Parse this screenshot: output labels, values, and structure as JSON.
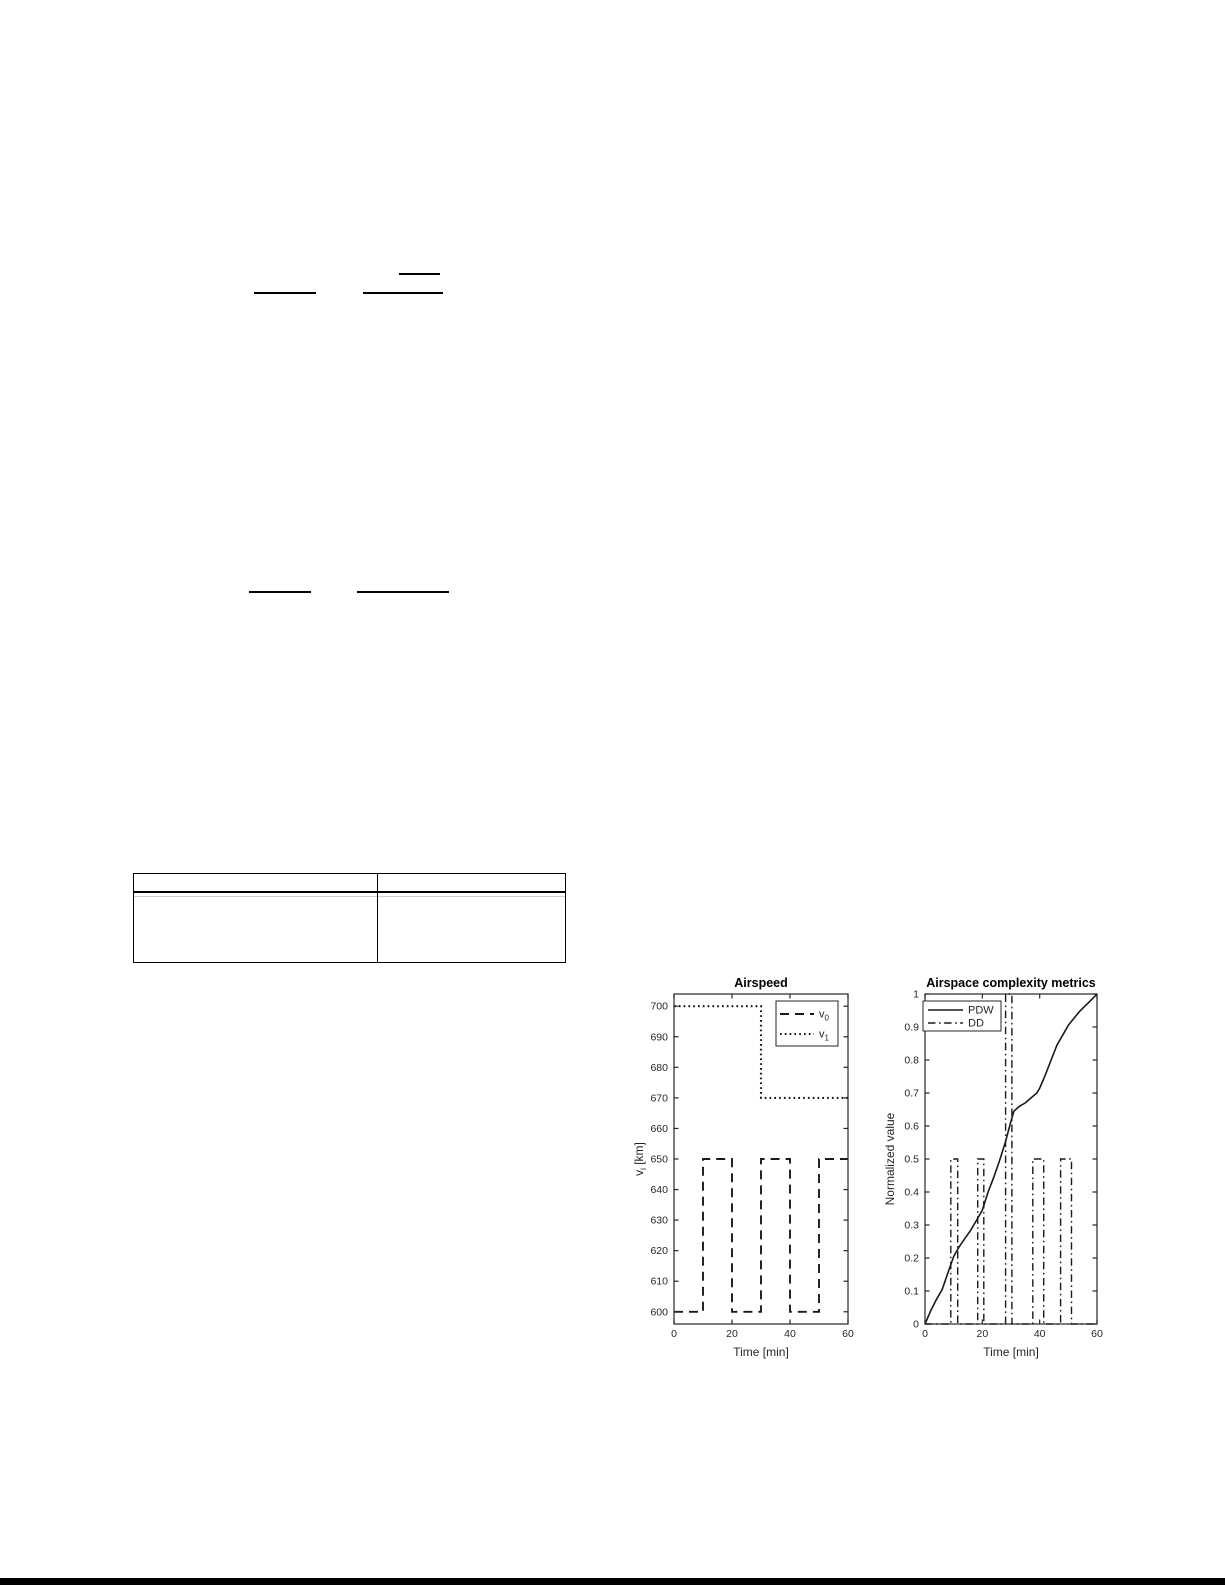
{
  "page": {
    "background": "#ffffff",
    "bottom_rule_color": "#000000"
  },
  "table": {
    "header_cells": [
      "",
      ""
    ],
    "body_cells": [
      "",
      ""
    ]
  },
  "colors": {
    "series": "#1a1a1a",
    "axis": "#262626",
    "title": "#000000",
    "legend_bg": "#ffffff"
  },
  "chart_data": [
    {
      "type": "line",
      "title": "Airspeed",
      "xlabel": "Time [min]",
      "ylabel": {
        "base": "v",
        "sub": "i",
        "rest": " [km]"
      },
      "xlim": [
        0,
        60
      ],
      "ylim": [
        596,
        704
      ],
      "xticks": [
        0,
        20,
        40,
        60
      ],
      "yticks": [
        600,
        610,
        620,
        630,
        640,
        650,
        660,
        670,
        680,
        690,
        700
      ],
      "grid": false,
      "legend_position": "top-right",
      "series": [
        {
          "name": {
            "base": "v",
            "sub": "0"
          },
          "style": "dashed",
          "points": [
            [
              0,
              600
            ],
            [
              10,
              600
            ],
            [
              10,
              650
            ],
            [
              20,
              650
            ],
            [
              20,
              600
            ],
            [
              30,
              600
            ],
            [
              30,
              650
            ],
            [
              40,
              650
            ],
            [
              40,
              600
            ],
            [
              50,
              600
            ],
            [
              50,
              650
            ],
            [
              60,
              650
            ]
          ]
        },
        {
          "name": {
            "base": "v",
            "sub": "1"
          },
          "style": "dotted",
          "points": [
            [
              0,
              700
            ],
            [
              30,
              700
            ],
            [
              30,
              670
            ],
            [
              60,
              670
            ]
          ]
        }
      ]
    },
    {
      "type": "line",
      "title": "Airspace complexity metrics",
      "xlabel": "Time [min]",
      "ylabel": {
        "base": "Normalized value",
        "sub": "",
        "rest": ""
      },
      "xlim": [
        0,
        60
      ],
      "ylim": [
        0,
        1
      ],
      "xticks": [
        0,
        20,
        40,
        60
      ],
      "yticks": [
        0,
        0.1,
        0.2,
        0.3,
        0.4,
        0.5,
        0.6,
        0.7,
        0.8,
        0.9,
        1
      ],
      "grid": false,
      "legend_position": "top-left",
      "series": [
        {
          "name": {
            "base": "PDW",
            "sub": ""
          },
          "style": "solid",
          "points": [
            [
              0,
              0
            ],
            [
              2,
              0.04
            ],
            [
              4,
              0.075
            ],
            [
              6,
              0.105
            ],
            [
              8,
              0.155
            ],
            [
              10,
              0.205
            ],
            [
              12,
              0.235
            ],
            [
              14,
              0.26
            ],
            [
              16,
              0.285
            ],
            [
              18,
              0.315
            ],
            [
              20,
              0.345
            ],
            [
              22,
              0.4
            ],
            [
              24,
              0.445
            ],
            [
              26,
              0.495
            ],
            [
              28,
              0.55
            ],
            [
              30,
              0.615
            ],
            [
              31,
              0.645
            ],
            [
              33,
              0.66
            ],
            [
              35,
              0.67
            ],
            [
              37,
              0.685
            ],
            [
              39,
              0.7
            ],
            [
              40,
              0.715
            ],
            [
              42,
              0.755
            ],
            [
              44,
              0.8
            ],
            [
              46,
              0.845
            ],
            [
              48,
              0.875
            ],
            [
              50,
              0.905
            ],
            [
              52,
              0.927
            ],
            [
              54,
              0.948
            ],
            [
              56,
              0.965
            ],
            [
              58,
              0.982
            ],
            [
              60,
              1
            ]
          ]
        },
        {
          "name": {
            "base": "DD",
            "sub": ""
          },
          "style": "dashdot",
          "points": [
            [
              0,
              0
            ],
            [
              9,
              0
            ],
            [
              9,
              0.5
            ],
            [
              11.4,
              0.5
            ],
            [
              11.4,
              0
            ],
            [
              18.4,
              0
            ],
            [
              18.4,
              0.5
            ],
            [
              20.5,
              0.5
            ],
            [
              20.5,
              0
            ],
            [
              28.1,
              0
            ],
            [
              28.1,
              1
            ],
            [
              30.3,
              1
            ],
            [
              30.3,
              0
            ],
            [
              37.6,
              0
            ],
            [
              37.6,
              0.5
            ],
            [
              41.4,
              0.5
            ],
            [
              41.4,
              0
            ],
            [
              47.3,
              0
            ],
            [
              47.3,
              0.5
            ],
            [
              51.1,
              0.5
            ],
            [
              51.1,
              0
            ],
            [
              60,
              0
            ]
          ]
        }
      ]
    }
  ]
}
